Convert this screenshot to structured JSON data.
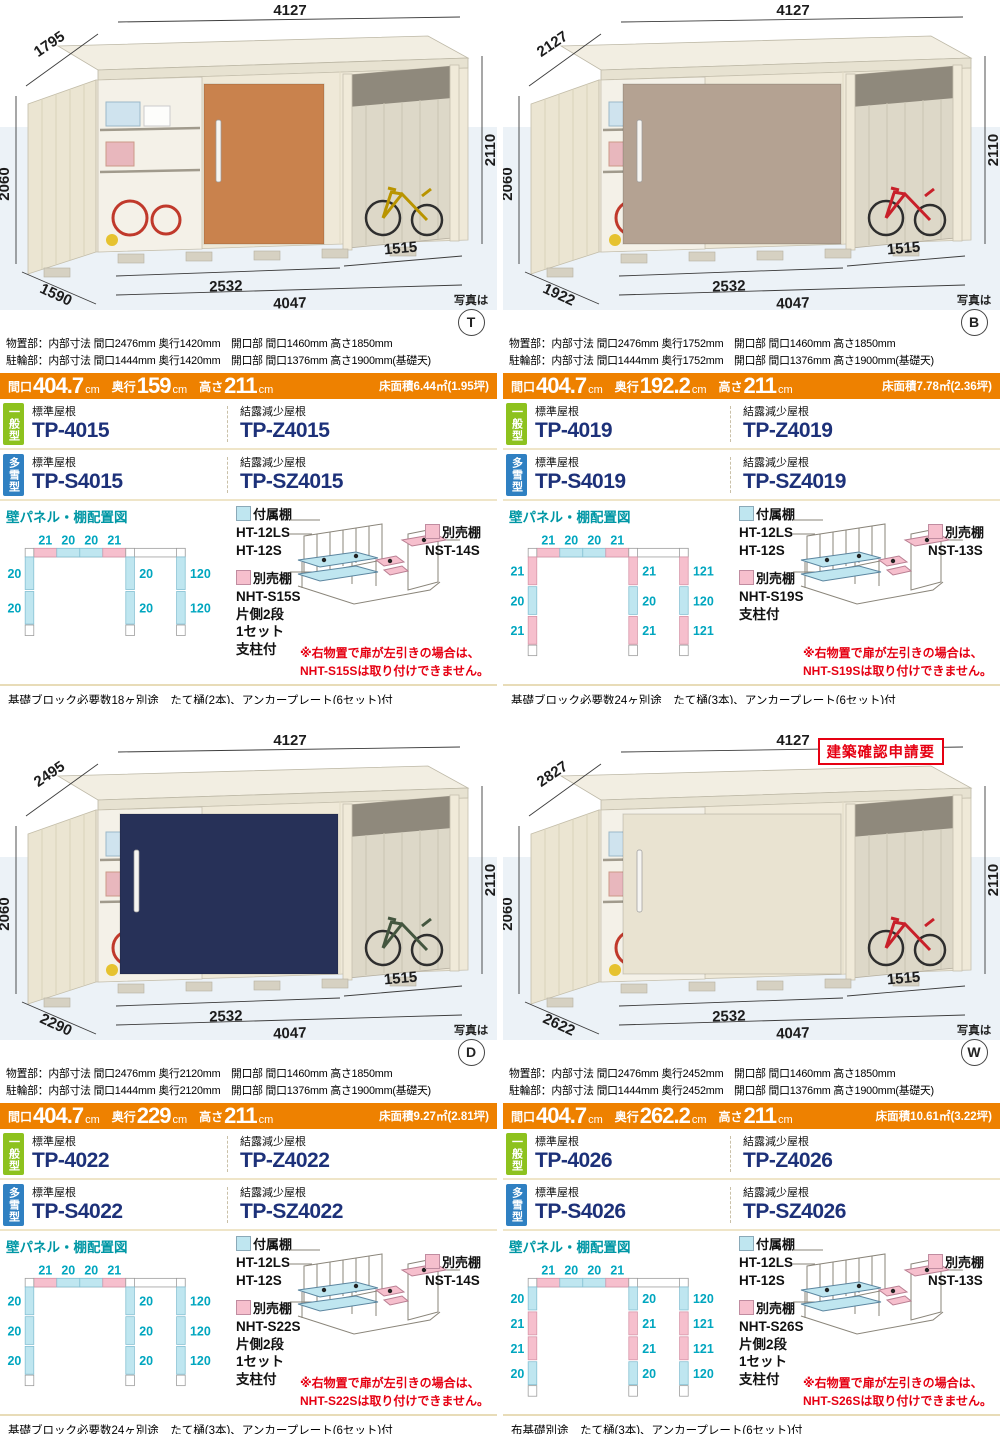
{
  "page": {
    "photo_caption": "写真は",
    "panel_heading": "壁パネル・棚配置図",
    "general_badge": "一般型",
    "snow_badge": "多雪型",
    "roof_std": "標準屋根",
    "roof_dew": "結露減少屋根",
    "legend": {
      "attached": "付属棚",
      "attached_models": "HT-12LS\nHT-12S",
      "optional": "別売棚"
    },
    "colors": {
      "orange": "#ee8100",
      "general_green": "#8dc21e",
      "snow_blue": "#2f80c2",
      "model_navy": "#1d3179",
      "panel_teal": "#00a6bf",
      "panel_pink": "#f6bfcd",
      "panel_cyan": "#bfe6f0",
      "warning_red": "#e60012",
      "rule_tan": "#e8dcb8"
    }
  },
  "products": [
    {
      "photo": {
        "badge": "T",
        "approval_note": "",
        "door_color": "#c9824d",
        "door_x": 204,
        "door_w": 120,
        "handle_x": 216,
        "vehicle_color": "#b99400",
        "interior_class": "",
        "dims": {
          "depth_top": "1795",
          "width_top": "4127",
          "height_left": "2060",
          "height_right": "2110",
          "front_storage": "2532",
          "front_total": "4047",
          "front_bay": "1515",
          "depth_bottom": "1590"
        }
      },
      "specs": {
        "storage": "物置部：内部寸法 間口2476mm 奥行1420mm　開口部 間口1460mm 高さ1850mm",
        "bicycle": "駐輪部：内部寸法 間口1444mm 奥行1420mm　開口部 間口1376mm 高さ1900mm(基礎天)"
      },
      "bar": {
        "w_label": "間口",
        "w": "404.7",
        "d_label": "奥行",
        "d": "159",
        "h_label": "高さ",
        "h": "211",
        "unit": "cm",
        "floor": "床面積6.44㎡(1.95坪)"
      },
      "models": {
        "general_std": "TP-4015",
        "general_dew": "TP-Z4015",
        "snow_std": "TP-S4015",
        "snow_dew": "TP-SZ4015"
      },
      "panel": {
        "top": [
          21,
          20,
          20,
          21
        ],
        "left": [
          20,
          20
        ],
        "middle": [
          20,
          20
        ],
        "right": [
          120,
          120
        ]
      },
      "shelves": {
        "optional_side": "NHT-S15S\n片側2段\n1セット\n支柱付",
        "optional_back": "NST-14S"
      },
      "warning": "※右物置で扉が左引きの場合は、\nNHT-S15Sは取り付けできません。",
      "foot": "基礎ブロック必要数18ヶ別途　たて樋(2本)、アンカープレート(6セット)付"
    },
    {
      "photo": {
        "badge": "B",
        "approval_note": "",
        "door_color": "#b4a292",
        "door_x": 120,
        "door_w": 218,
        "handle_x": 134,
        "vehicle_color": "#c8202a",
        "interior_class": "hide",
        "dims": {
          "depth_top": "2127",
          "width_top": "4127",
          "height_left": "2060",
          "height_right": "2110",
          "front_storage": "2532",
          "front_total": "4047",
          "front_bay": "1515",
          "depth_bottom": "1922"
        }
      },
      "specs": {
        "storage": "物置部：内部寸法 間口2476mm 奥行1752mm　開口部 間口1460mm 高さ1850mm",
        "bicycle": "駐輪部：内部寸法 間口1444mm 奥行1752mm　開口部 間口1376mm 高さ1900mm(基礎天)"
      },
      "bar": {
        "w_label": "間口",
        "w": "404.7",
        "d_label": "奥行",
        "d": "192.2",
        "h_label": "高さ",
        "h": "211",
        "unit": "cm",
        "floor": "床面積7.78㎡(2.36坪)"
      },
      "models": {
        "general_std": "TP-4019",
        "general_dew": "TP-Z4019",
        "snow_std": "TP-S4019",
        "snow_dew": "TP-SZ4019"
      },
      "panel": {
        "top": [
          21,
          20,
          20,
          21
        ],
        "left": [
          21,
          20,
          21
        ],
        "middle": [
          21,
          20,
          21
        ],
        "right": [
          121,
          120,
          121
        ]
      },
      "shelves": {
        "optional_side": "NHT-S19S\n支柱付",
        "optional_back": "NST-13S"
      },
      "warning": "※右物置で扉が左引きの場合は、\nNHT-S19Sは取り付けできません。",
      "foot": "基礎ブロック必要数24ヶ別途　たて樋(3本)、アンカープレート(6セット)付"
    },
    {
      "photo": {
        "badge": "D",
        "approval_note": "",
        "door_color": "#273158",
        "door_x": 120,
        "door_w": 218,
        "handle_x": 134,
        "vehicle_color": "#44563f",
        "interior_class": "hide",
        "dims": {
          "depth_top": "2495",
          "width_top": "4127",
          "height_left": "2060",
          "height_right": "2110",
          "front_storage": "2532",
          "front_total": "4047",
          "front_bay": "1515",
          "depth_bottom": "2290"
        }
      },
      "specs": {
        "storage": "物置部：内部寸法 間口2476mm 奥行2120mm　開口部 間口1460mm 高さ1850mm",
        "bicycle": "駐輪部：内部寸法 間口1444mm 奥行2120mm　開口部 間口1376mm 高さ1900mm(基礎天)"
      },
      "bar": {
        "w_label": "間口",
        "w": "404.7",
        "d_label": "奥行",
        "d": "229",
        "h_label": "高さ",
        "h": "211",
        "unit": "cm",
        "floor": "床面積9.27㎡(2.81坪)"
      },
      "models": {
        "general_std": "TP-4022",
        "general_dew": "TP-Z4022",
        "snow_std": "TP-S4022",
        "snow_dew": "TP-SZ4022"
      },
      "panel": {
        "top": [
          21,
          20,
          20,
          21
        ],
        "left": [
          20,
          20,
          20
        ],
        "middle": [
          20,
          20,
          20
        ],
        "right": [
          120,
          120,
          120
        ]
      },
      "shelves": {
        "optional_side": "NHT-S22S\n片側2段\n1セット\n支柱付",
        "optional_back": "NST-14S"
      },
      "warning": "※右物置で扉が左引きの場合は、\nNHT-S22Sは取り付けできません。",
      "foot": "基礎ブロック必要数24ヶ別途　たて樋(3本)、アンカープレート(6セット)付"
    },
    {
      "photo": {
        "badge": "W",
        "approval_note": "建築確認申請要",
        "door_color": "#e9e3d1",
        "door_x": 120,
        "door_w": 218,
        "handle_x": 134,
        "vehicle_color": "#c8202a",
        "interior_class": "hide",
        "dims": {
          "depth_top": "2827",
          "width_top": "4127",
          "height_left": "2060",
          "height_right": "2110",
          "front_storage": "2532",
          "front_total": "4047",
          "front_bay": "1515",
          "depth_bottom": "2622"
        }
      },
      "specs": {
        "storage": "物置部：内部寸法 間口2476mm 奥行2452mm　開口部 間口1460mm 高さ1850mm",
        "bicycle": "駐輪部：内部寸法 間口1444mm 奥行2452mm　開口部 間口1376mm 高さ1900mm(基礎天)"
      },
      "bar": {
        "w_label": "間口",
        "w": "404.7",
        "d_label": "奥行",
        "d": "262.2",
        "h_label": "高さ",
        "h": "211",
        "unit": "cm",
        "floor": "床面積10.61㎡(3.22坪)"
      },
      "models": {
        "general_std": "TP-4026",
        "general_dew": "TP-Z4026",
        "snow_std": "TP-S4026",
        "snow_dew": "TP-SZ4026"
      },
      "panel": {
        "top": [
          21,
          20,
          20,
          21
        ],
        "left": [
          20,
          21,
          21,
          20
        ],
        "middle": [
          20,
          21,
          21,
          20
        ],
        "right": [
          120,
          121,
          121,
          120
        ]
      },
      "shelves": {
        "optional_side": "NHT-S26S\n片側2段\n1セット\n支柱付",
        "optional_back": "NST-13S"
      },
      "warning": "※右物置で扉が左引きの場合は、\nNHT-S26Sは取り付けできません。",
      "foot": "布基礎別途　たて樋(3本)、アンカープレート(6セット)付"
    }
  ]
}
